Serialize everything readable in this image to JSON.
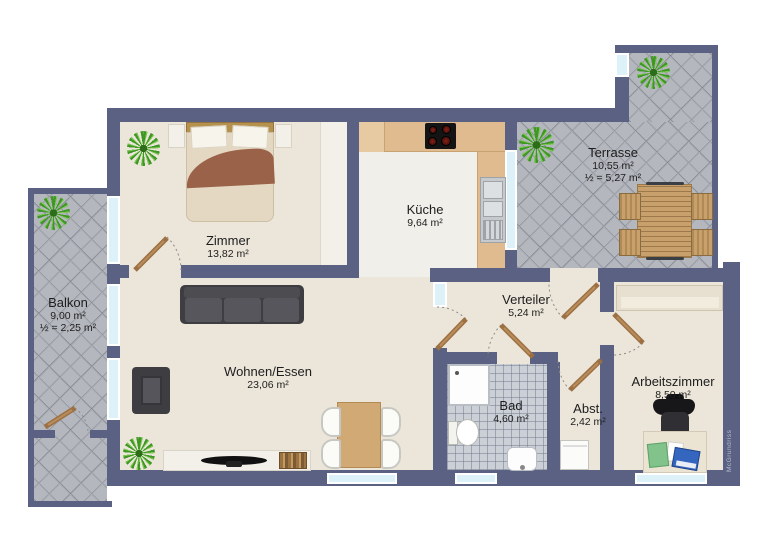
{
  "title": "Wohnung Grundriss",
  "watermark": "McGrundriss",
  "colors": {
    "wall": "#5a6183",
    "window_glass": "#ddf1f9",
    "floor": "#ece6da",
    "outdoor_tile": "#b5b7be",
    "bath_tile": "#cbd0d7",
    "kitchen_counter": "#dfbb8f",
    "door_leaf": "#9c7042",
    "plant_green": "#3f9726"
  },
  "rooms": [
    {
      "name": "Zimmer",
      "area": "13,82 m²"
    },
    {
      "name": "Küche",
      "area": "9,64 m²"
    },
    {
      "name": "Terrasse",
      "area": "10,55 m²",
      "half": "½ = 5,27 m²"
    },
    {
      "name": "Balkon",
      "area": "9,00 m²",
      "half": "½ = 2,25 m²"
    },
    {
      "name": "Wohnen/Essen",
      "area": "23,06 m²"
    },
    {
      "name": "Verteiler",
      "area": "5,24 m²"
    },
    {
      "name": "Bad",
      "area": "4,60 m²"
    },
    {
      "name": "Abst.",
      "area": "2,42 m²"
    },
    {
      "name": "Arbeitszimmer",
      "area": "8,50 m²"
    }
  ]
}
